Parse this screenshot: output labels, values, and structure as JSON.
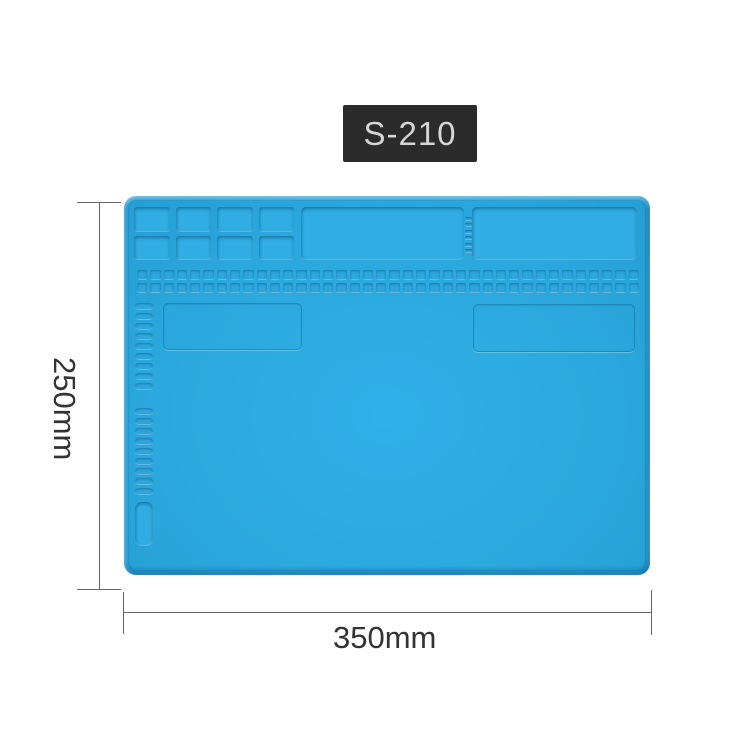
{
  "product": {
    "model_label": "S-210",
    "label_bg": "#2b2b2b",
    "label_text_color": "#d6d6d6"
  },
  "dimensions": {
    "height_label": "250mm",
    "width_label": "350mm",
    "line_color": "#666666",
    "text_color": "#333333"
  },
  "mat": {
    "description": "blue silicone soldering repair mat",
    "body_color": "#2ba9de",
    "recess_color": "#30ade2",
    "compartment_grid": {
      "rows": 2,
      "cols": 4
    },
    "divider_notch_count": 6,
    "hole_grid": {
      "rows": 2,
      "cols": 38
    },
    "slot_column_upper_count": 9,
    "slot_column_lower_count": 9
  },
  "counts": {
    "compartments": 8,
    "holes": 76,
    "upper_pills": 9,
    "lower_pills": 9,
    "notches": 6
  }
}
